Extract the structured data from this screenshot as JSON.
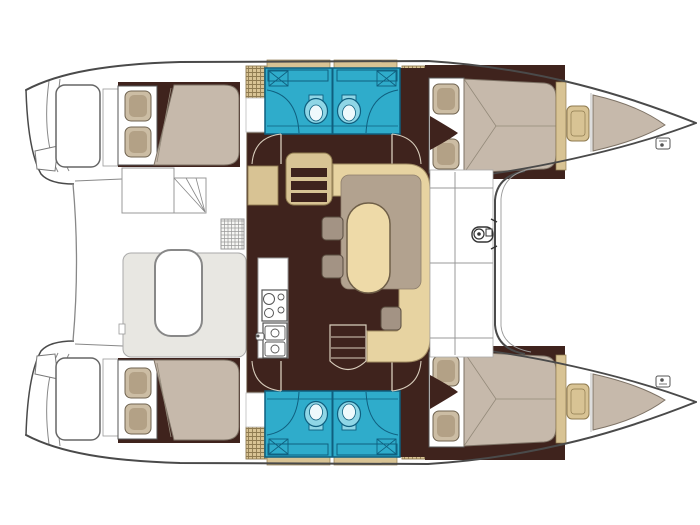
{
  "diagram": {
    "type": "boat-floor-plan",
    "subject": "catamaran-layout-top-view",
    "visible_text": [],
    "rooms": [
      "port-aft-cabin",
      "port-bathroom",
      "port-forward-cabin",
      "port-forepeak",
      "starboard-aft-cabin",
      "starboard-bathroom",
      "starboard-forward-cabin",
      "starboard-forepeak",
      "saloon",
      "galley",
      "cockpit",
      "foredeck"
    ],
    "fixtures": [
      "double-berth",
      "pillows",
      "toilet",
      "washbasin",
      "shower",
      "wardrobe-louvered",
      "steps",
      "stove-two-burner",
      "double-sink",
      "dinette-u-sofa",
      "oval-table",
      "stools",
      "fridge-grate",
      "cockpit-bench",
      "cockpit-table",
      "stern-seat",
      "transom-steps",
      "windlass",
      "bow-cleat",
      "trampoline-edge",
      "hull-doors"
    ]
  },
  "palette": {
    "background": "#ffffff",
    "line": "#4a4a4a",
    "thinline": "#888888",
    "floor": "#3f231d",
    "mattress": "#c6b9ab",
    "mattress_edge": "#7d7265",
    "seam": "#948a7a",
    "pillow_outer": "#ccbda4",
    "pillow_inner": "#b3a186",
    "cabinet": "#d8c394",
    "hatchline": "#8f7b50",
    "sofa": "#e7d3a1",
    "sofa_edge": "#a18c63",
    "backrest": "#b2a28f",
    "table_top": "#eedaa8",
    "table_edge": "#6f5f48",
    "stool": "#a39384",
    "stool_edge": "#5a4c3f",
    "teal": "#2faccb",
    "teal_line": "#0f5f7f",
    "teal_light": "#8fd6e6",
    "teal_pale": "#eef9fc",
    "bench": "#e8e7e2",
    "door_line": "#d8cdbc",
    "white": "#ffffff"
  }
}
